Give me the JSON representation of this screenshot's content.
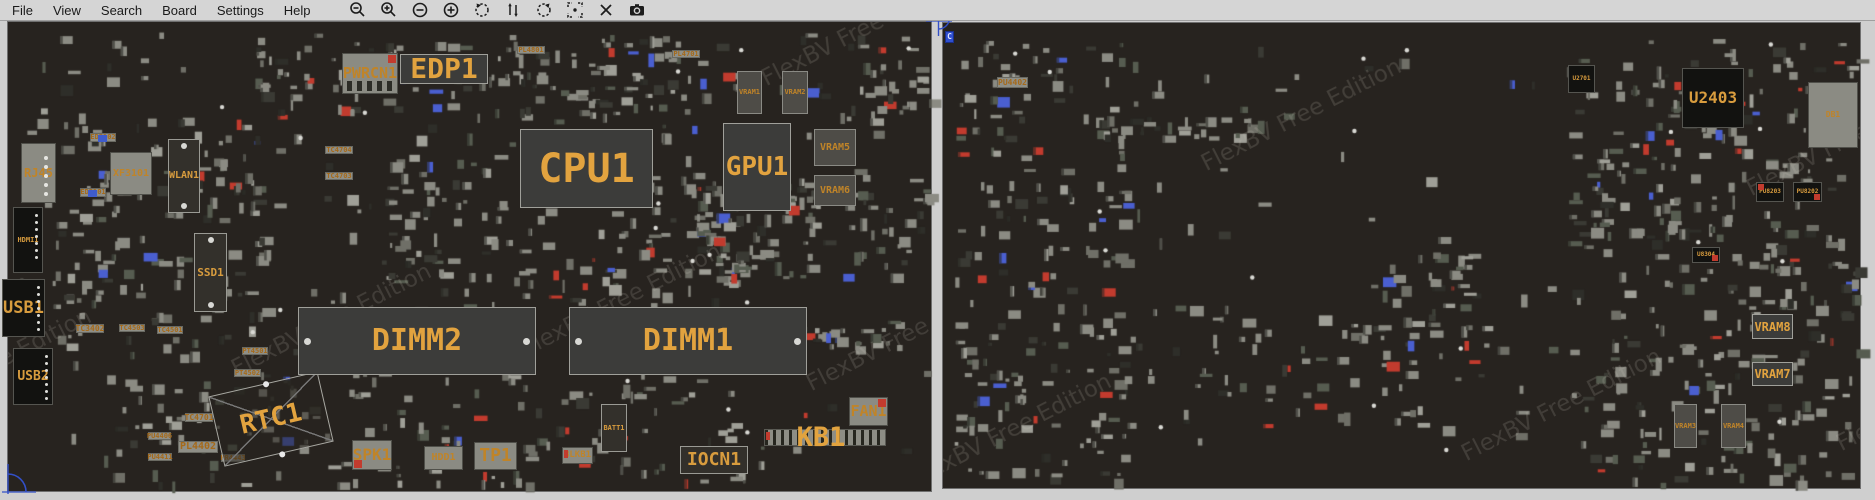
{
  "menu": {
    "items": [
      "File",
      "View",
      "Search",
      "Board",
      "Settings",
      "Help"
    ]
  },
  "toolbar": {
    "icons": [
      "zoom-out",
      "zoom-in",
      "minus-circle",
      "plus-circle",
      "rotate-ccw",
      "flip-vertical",
      "rotate-cw",
      "center-view",
      "close",
      "screenshot"
    ]
  },
  "watermark": {
    "text": "FlexBV Free Edition"
  },
  "colors": {
    "menubar_bg": "#d5d5d5",
    "board_bg": "#27231f",
    "component_gray": "#8b8b83",
    "label_orange": "#e2a33f",
    "accent_red": "#c23b2e",
    "accent_blue": "#3f5ccc"
  },
  "front_board": {
    "side": "front",
    "panel": {
      "x": 7,
      "y": 21,
      "w": 925,
      "h": 471
    },
    "components": [
      {
        "label": "PWRCN1",
        "x": 342,
        "y": 53,
        "w": 56,
        "h": 41,
        "style": "conn",
        "fs": 15,
        "cls": "acc-tr slots"
      },
      {
        "label": "EDP1",
        "x": 400,
        "y": 54,
        "w": 88,
        "h": 30,
        "style": "bigchip",
        "fs": 28
      },
      {
        "label": "CPU1",
        "x": 520,
        "y": 129,
        "w": 133,
        "h": 79,
        "style": "bigchip",
        "fs": 40
      },
      {
        "label": "GPU1",
        "x": 723,
        "y": 123,
        "w": 68,
        "h": 88,
        "style": "bigchip",
        "fs": 26
      },
      {
        "label": "VRAM1",
        "x": 737,
        "y": 71,
        "w": 25,
        "h": 43,
        "style": "chipgray",
        "fs": 7
      },
      {
        "label": "VRAM2",
        "x": 782,
        "y": 71,
        "w": 26,
        "h": 43,
        "style": "chipgray",
        "fs": 7
      },
      {
        "label": "VRAM5",
        "x": 814,
        "y": 129,
        "w": 42,
        "h": 37,
        "style": "chipgray",
        "fs": 10
      },
      {
        "label": "VRAM6",
        "x": 814,
        "y": 175,
        "w": 42,
        "h": 31,
        "style": "chipgray",
        "fs": 10
      },
      {
        "label": "RJ45",
        "x": 21,
        "y": 143,
        "w": 35,
        "h": 60,
        "style": "conn",
        "fs": 12,
        "cls": "pads-right"
      },
      {
        "label": "XF3101",
        "x": 110,
        "y": 152,
        "w": 42,
        "h": 43,
        "style": "conn",
        "fs": 10
      },
      {
        "label": "WLAN1",
        "x": 168,
        "y": 139,
        "w": 32,
        "h": 74,
        "style": "outline",
        "fs": 10,
        "cls": "pads-tb"
      },
      {
        "label": "ED3102",
        "x": 90,
        "y": 133,
        "w": 26,
        "h": 9,
        "style": "strip",
        "fs": 7,
        "cls": "acc-blue-mid"
      },
      {
        "label": "ED3101",
        "x": 80,
        "y": 188,
        "w": 26,
        "h": 9,
        "style": "strip",
        "fs": 7,
        "cls": "acc-blue-mid"
      },
      {
        "label": "HDMI1",
        "x": 13,
        "y": 207,
        "w": 30,
        "h": 66,
        "style": "black",
        "fs": 7,
        "cls": "pads-right-dense"
      },
      {
        "label": "USB1",
        "x": 2,
        "y": 279,
        "w": 43,
        "h": 58,
        "style": "black",
        "fs": 17,
        "cls": "pads-right-dense"
      },
      {
        "label": "USB2",
        "x": 13,
        "y": 348,
        "w": 40,
        "h": 57,
        "style": "black",
        "fs": 13,
        "cls": "pads-right-dense"
      },
      {
        "label": "SSD1",
        "x": 194,
        "y": 233,
        "w": 33,
        "h": 79,
        "style": "outline",
        "fs": 11,
        "cls": "pads-tb"
      },
      {
        "label": "TC4704",
        "x": 325,
        "y": 146,
        "w": 28,
        "h": 8,
        "style": "strip",
        "fs": 7
      },
      {
        "label": "TC4703",
        "x": 325,
        "y": 172,
        "w": 28,
        "h": 8,
        "style": "strip",
        "fs": 7
      },
      {
        "label": "PL4801",
        "x": 517,
        "y": 46,
        "w": 28,
        "h": 8,
        "style": "strip",
        "fs": 7
      },
      {
        "label": "PL4701",
        "x": 672,
        "y": 50,
        "w": 28,
        "h": 8,
        "style": "strip",
        "fs": 7
      },
      {
        "label": "TC3402",
        "x": 76,
        "y": 324,
        "w": 28,
        "h": 9,
        "style": "strip",
        "fs": 8
      },
      {
        "label": "TC4503",
        "x": 119,
        "y": 324,
        "w": 26,
        "h": 8,
        "style": "strip",
        "fs": 7
      },
      {
        "label": "TC4501",
        "x": 157,
        "y": 326,
        "w": 26,
        "h": 8,
        "style": "strip",
        "fs": 7
      },
      {
        "label": "PT4501",
        "x": 242,
        "y": 347,
        "w": 26,
        "h": 8,
        "style": "strip",
        "fs": 7
      },
      {
        "label": "PT4502",
        "x": 234,
        "y": 369,
        "w": 27,
        "h": 8,
        "style": "strip",
        "fs": 7
      },
      {
        "label": "TC4701",
        "x": 185,
        "y": 413,
        "w": 28,
        "h": 9,
        "style": "strip",
        "fs": 8
      },
      {
        "label": "PU4406",
        "x": 148,
        "y": 432,
        "w": 23,
        "h": 8,
        "style": "strip",
        "fs": 7
      },
      {
        "label": "PL4402",
        "x": 178,
        "y": 441,
        "w": 40,
        "h": 12,
        "style": "strip",
        "fs": 10
      },
      {
        "label": "PU4411",
        "x": 148,
        "y": 453,
        "w": 24,
        "h": 8,
        "style": "strip",
        "fs": 7
      },
      {
        "label": "PR4443",
        "x": 221,
        "y": 454,
        "w": 24,
        "h": 8,
        "style": "strip",
        "fs": 7
      },
      {
        "label": "RTC1",
        "x": 215,
        "y": 383,
        "w": 112,
        "h": 72,
        "style": "rtc",
        "fs": 26,
        "rot": -13
      },
      {
        "label": "DIMM2",
        "x": 298,
        "y": 307,
        "w": 238,
        "h": 68,
        "style": "bigchip",
        "fs": 30,
        "cls": "dots-lr"
      },
      {
        "label": "DIMM1",
        "x": 569,
        "y": 307,
        "w": 238,
        "h": 68,
        "style": "bigchip",
        "fs": 30,
        "cls": "dots-lr"
      },
      {
        "label": "SPK1",
        "x": 352,
        "y": 440,
        "w": 40,
        "h": 30,
        "style": "conn",
        "fs": 16,
        "cls": "acc-bl"
      },
      {
        "label": "HDD1",
        "x": 424,
        "y": 446,
        "w": 39,
        "h": 24,
        "style": "conn",
        "fs": 10
      },
      {
        "label": "TP1",
        "x": 474,
        "y": 442,
        "w": 43,
        "h": 28,
        "style": "conn",
        "fs": 18
      },
      {
        "label": "BLKB1",
        "x": 562,
        "y": 447,
        "w": 31,
        "h": 17,
        "style": "conn",
        "fs": 9,
        "cls": "acc-left"
      },
      {
        "label": "BATT1",
        "x": 601,
        "y": 404,
        "w": 26,
        "h": 48,
        "style": "outline",
        "fs": 7
      },
      {
        "label": "IOCN1",
        "x": 680,
        "y": 446,
        "w": 68,
        "h": 28,
        "style": "outline",
        "fs": 18
      },
      {
        "label": "",
        "name": "kb1-connector",
        "x": 764,
        "y": 429,
        "w": 122,
        "h": 17,
        "style": "kbstrip",
        "fs": 8,
        "cls": "acc-left"
      },
      {
        "label": "KB1",
        "x": 786,
        "y": 420,
        "w": 70,
        "h": 34,
        "style": "label",
        "fs": 27
      },
      {
        "label": "FAN1",
        "x": 849,
        "y": 397,
        "w": 39,
        "h": 29,
        "style": "conn",
        "fs": 15,
        "cls": "acc-tr"
      }
    ]
  },
  "back_board": {
    "side": "back",
    "panel": {
      "x": 942,
      "y": 22,
      "w": 919,
      "h": 467
    },
    "components": [
      {
        "label": "PU4402",
        "x": 997,
        "y": 77,
        "w": 31,
        "h": 11,
        "style": "strip",
        "fs": 8
      },
      {
        "label": "C",
        "x": 945,
        "y": 31,
        "w": 9,
        "h": 12,
        "style": "bluemark",
        "fs": 8
      },
      {
        "label": "U2701",
        "x": 1568,
        "y": 65,
        "w": 27,
        "h": 28,
        "style": "black",
        "fs": 6
      },
      {
        "label": "U2403",
        "x": 1682,
        "y": 68,
        "w": 62,
        "h": 60,
        "style": "black",
        "fs": 16
      },
      {
        "label": "DB1",
        "x": 1808,
        "y": 82,
        "w": 50,
        "h": 66,
        "style": "conn",
        "fs": 8
      },
      {
        "label": "PU8203",
        "x": 1756,
        "y": 182,
        "w": 28,
        "h": 20,
        "style": "black",
        "fs": 6,
        "cls": "acc-tl"
      },
      {
        "label": "PU8202",
        "x": 1793,
        "y": 182,
        "w": 29,
        "h": 20,
        "style": "black",
        "fs": 6,
        "cls": "acc-br"
      },
      {
        "label": "U8304",
        "x": 1692,
        "y": 247,
        "w": 28,
        "h": 16,
        "style": "black",
        "fs": 6,
        "cls": "acc-br"
      },
      {
        "label": "VRAM8",
        "x": 1752,
        "y": 314,
        "w": 41,
        "h": 25,
        "style": "bigchip",
        "fs": 12
      },
      {
        "label": "VRAM7",
        "x": 1752,
        "y": 362,
        "w": 41,
        "h": 24,
        "style": "bigchip",
        "fs": 12
      },
      {
        "label": "VRAM3",
        "x": 1674,
        "y": 404,
        "w": 23,
        "h": 44,
        "style": "chipgray",
        "fs": 7
      },
      {
        "label": "VRAM4",
        "x": 1721,
        "y": 404,
        "w": 25,
        "h": 44,
        "style": "chipgray",
        "fs": 7
      }
    ]
  }
}
